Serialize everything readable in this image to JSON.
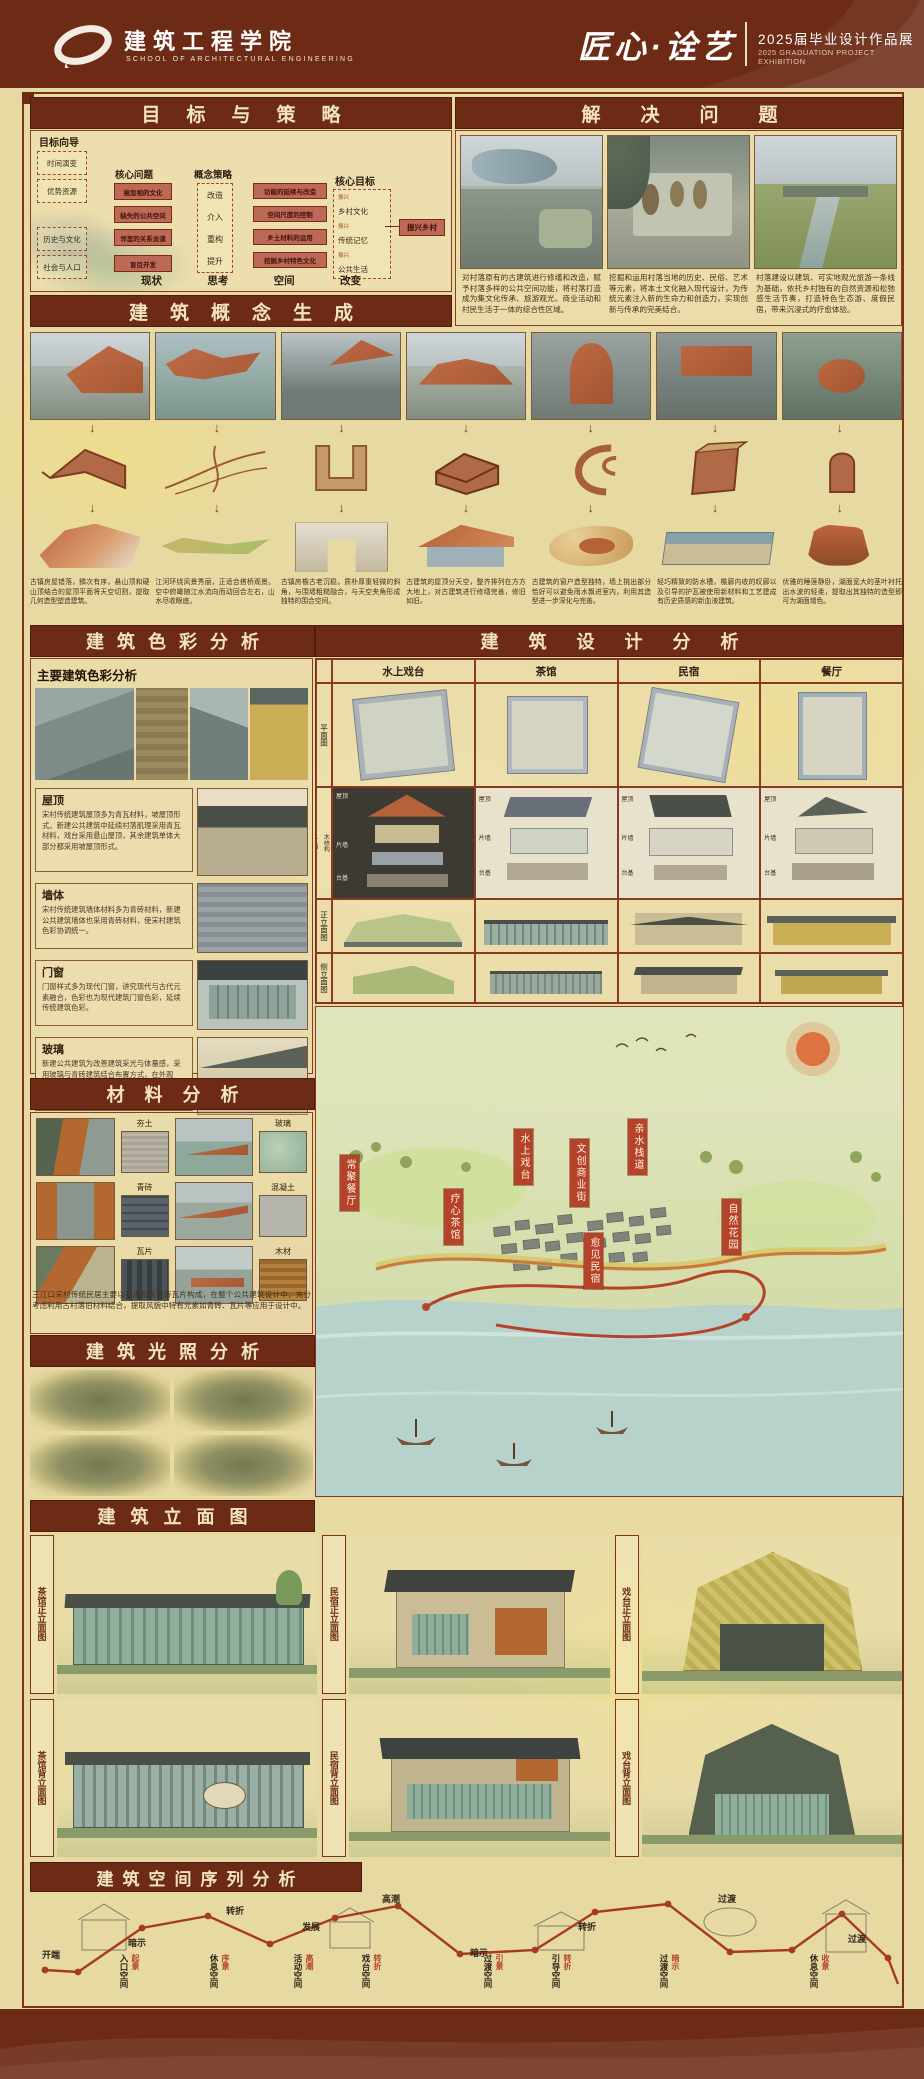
{
  "header": {
    "school_cn": "建筑工程学院",
    "school_en": "SCHOOL OF ARCHITECTURAL ENGINEERING",
    "title": "匠心·诠艺",
    "exhibition_cn": "2025届毕业设计作品展",
    "exhibition_en": "2025 GRADUATION PROJECT EXHIBITION"
  },
  "goals": {
    "title": "目标与策略",
    "guide_label": "目标向导",
    "inputs_top": [
      "时间演变",
      "优势资源"
    ],
    "inputs_bottom": [
      "历史与文化",
      "社会与人口"
    ],
    "problems_label": "核心问题",
    "problems": [
      "被忽视的文化",
      "缺失的公共空间",
      "邻里的关系淡漠",
      "盲目开发"
    ],
    "strategy_label": "概念策略",
    "strategies": [
      "改造",
      "介入",
      "重构",
      "提升"
    ],
    "measures": [
      "功能的延续与改造",
      "空间尺度的控制",
      "乡土材料的运用",
      "挖掘乡村特色文化"
    ],
    "goal_label": "核心目标",
    "goal_items": [
      "振兴",
      "乡村文化",
      "振兴",
      "传统记忆",
      "振兴",
      "公共生活"
    ],
    "goal_result": "振兴乡村",
    "keywords": [
      "现状",
      "思考",
      "空间",
      "改变"
    ]
  },
  "problems_section": {
    "title": "解决问题",
    "paragraphs": [
      "对村落原有的古建筑进行修缮和改造，赋予村落多样的公共空间功能，将村落打造成为集文化传承、旅游观光、商业活动和村民生活于一体的综合性区域。",
      "挖掘和运用村落当地的历史、民俗、艺术等元素，将本土文化融入现代设计，为传统元素注入新的生命力和创造力，实现创新与传承的完美结合。",
      "村落建设以建筑、可实地观光旅游一条线为基础，依托乡村独有的自然资源和松弛感生活节奏，打造特色生态游、度假民宿，带来沉浸式的疗愈体验。"
    ]
  },
  "concept": {
    "title": "建筑概念生成",
    "arrow": "↓",
    "captions": [
      "古镇房屋错落，鳞次有序，悬山顶和硬山顶结合的屋顶平面将天空切割，提取几何造型塑造建筑。",
      "江河环绕风景秀丽，正适合搭桥观景。空中俯瞰随江水流向而动回合左右，山水尽收眼底。",
      "古镇房檐古老沉稳，质朴厚重轻微的斜角，与围墙粗糙融合，与天空夹角形成独特的围合空间。",
      "古建筑的屋顶分天空，整齐排列在方方大地上，对古建筑进行修缮完善，修旧如旧。",
      "古建筑的窗户造型独特，墙上挑出部分恰好可以避免雨水飘进室内，利用其造型进一步深化与完善。",
      "轻巧精致的防水槽，檐廊内收的叹廊以及引导的护瓦被使用新材料和工艺建成有历史质感的新血液建筑。",
      "优雅的睡莲静卧，湖面宽大的茎叶衬托出水波的轻柔，提取出其独特的造型即可为湖面增色。"
    ]
  },
  "color_analysis": {
    "title": "建筑色彩分析",
    "subtitle": "主要建筑色彩分析",
    "boxes": [
      {
        "label": "屋顶",
        "text": "宋村传统建筑屋顶多为青瓦材料，坡屋顶形式。新建公共建筑中延续村落肌理采用青瓦材料，戏台采用悬山屋顶，其余建筑单体大部分都采用坡屋顶形式。"
      },
      {
        "label": "墙体",
        "text": "宋村传统建筑墙体材料多为青砖材料，新建公共建筑墙体也采用青砖材料，使宋村建筑色彩协调统一。"
      },
      {
        "label": "门窗",
        "text": "门窗样式多为现代门窗，讲究现代与古代元素融合，色彩也为现代建筑门窗色彩，延续传统建筑色彩。"
      },
      {
        "label": "玻璃",
        "text": "新建公共建筑为改善建筑采光与体量感，采用玻璃与青砖建筑结合布置方式，在外观上，传统的石材墙层被建筑拐角处的玻璃观景打断。"
      }
    ]
  },
  "design": {
    "title": "建筑设计分析",
    "columns": [
      "水上戏台",
      "茶馆",
      "民宿",
      "餐厅"
    ],
    "row_plan": "平面图",
    "row_explode": "爆炸分析图",
    "row_front": "正立面图",
    "row_side": "侧立面图",
    "explode_parts": [
      "屋顶",
      "木结构",
      "片墙",
      "台基"
    ],
    "cell_parts": [
      "屋顶",
      "片墙",
      "台基"
    ]
  },
  "materials": {
    "title": "材料分析",
    "items": [
      "夯土",
      "玻璃",
      "青砖",
      "混凝土",
      "瓦片",
      "木材"
    ],
    "note": "三江口宋村传统民居主要以石木和灰青砖瓦片构成，在整个公共建筑设计中，充分考虑利用古村落旧材料结合，提取风貌中特有元素如青砖、瓦片等应用于设计中。"
  },
  "lighting": {
    "title": "建筑光照分析"
  },
  "masterplan": {
    "tags": [
      "常聚餐厅",
      "水上戏台",
      "文创商业街",
      "亲水栈道",
      "疗心茶馆",
      "愈见民宿",
      "自然花园"
    ]
  },
  "elevations": {
    "title": "建筑立面图",
    "labels": [
      "茶馆正立面图",
      "民宿正立面图",
      "戏台正立面图",
      "茶馆背立面图",
      "民宿背立面图",
      "戏台背立面图"
    ]
  },
  "sequence": {
    "title": "建筑空间序列分析",
    "path_labels": [
      "开端",
      "暗示",
      "转折",
      "发展",
      "高潮",
      "暗示",
      "转折",
      "过渡",
      "过渡"
    ],
    "spaces": [
      {
        "name": "入口空间",
        "tag": "起景"
      },
      {
        "name": "休息空间",
        "tag": "序景"
      },
      {
        "name": "活动空间",
        "tag": "高潮"
      },
      {
        "name": "戏台空间",
        "tag": "转折"
      },
      {
        "name": "过渡空间",
        "tag": "引景"
      },
      {
        "name": "引导空间",
        "tag": "转折"
      },
      {
        "name": "过渡空间",
        "tag": "暗示"
      },
      {
        "name": "休息空间",
        "tag": "收景"
      }
    ]
  }
}
